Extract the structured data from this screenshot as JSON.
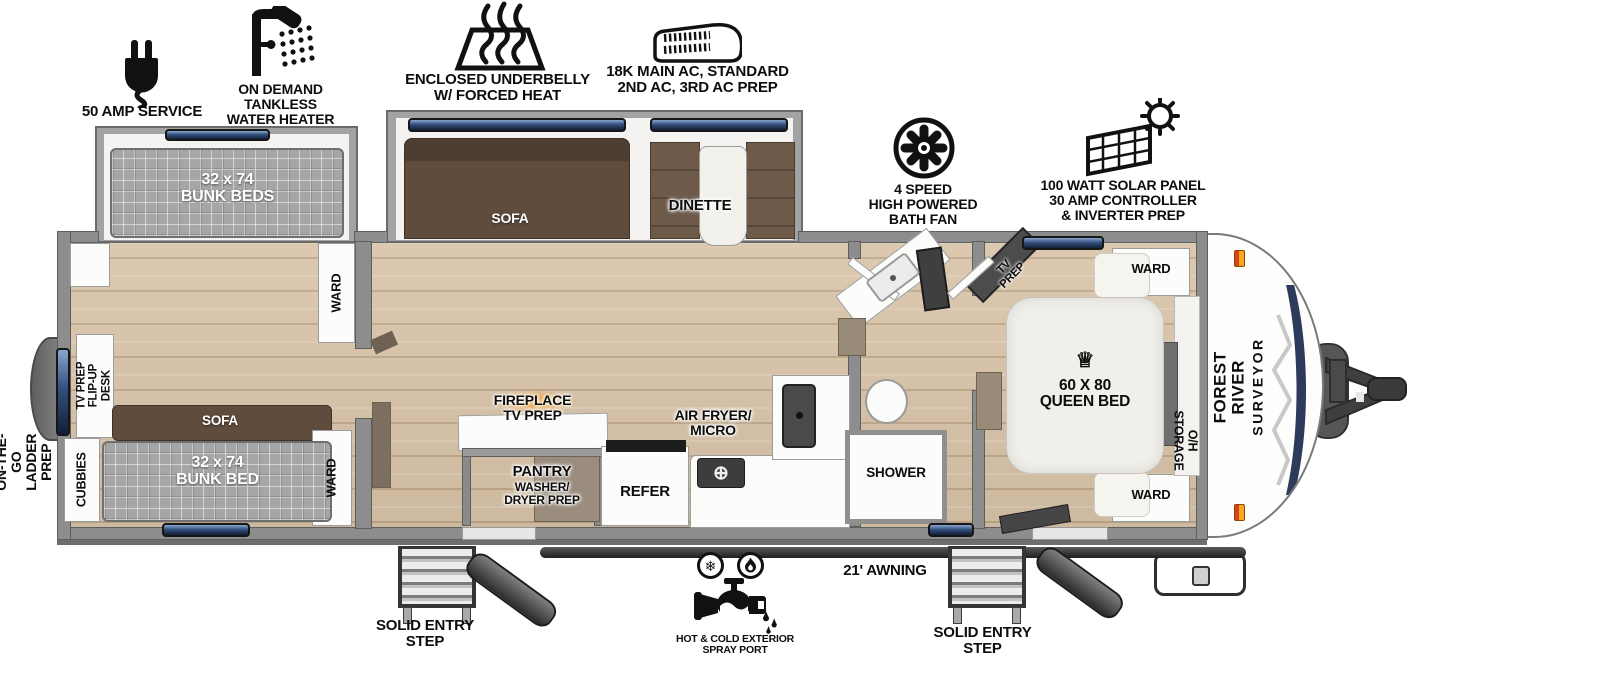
{
  "features": {
    "amp_service": "50 AMP SERVICE",
    "water_heater": "ON DEMAND\nTANKLESS\nWATER HEATER",
    "underbelly": "ENCLOSED UNDERBELLY\nW/ FORCED HEAT",
    "ac": "18K MAIN AC, STANDARD\n2ND AC, 3RD AC PREP",
    "bath_fan": "4 SPEED\nHIGH POWERED\nBATH FAN",
    "solar": "100 WATT SOLAR PANEL\n30 AMP CONTROLLER\n& INVERTER PREP"
  },
  "exterior": {
    "ladder_prep": "ON-THE-GO\nLADDER PREP",
    "awning": "21' AWNING",
    "spray_port": "HOT & COLD EXTERIOR\nSPRAY PORT",
    "entry_step_left": "SOLID ENTRY\nSTEP",
    "entry_step_right": "SOLID ENTRY\nSTEP",
    "brand_name": "FOREST RIVER",
    "brand_model": "SURVEYOR"
  },
  "bunk_room": {
    "bunk_beds_slide": "32 x 74\nBUNK BEDS",
    "ward_top": "WARD",
    "tv_prep_desk": "TV PREP\nFLIP-UP DESK",
    "sofa": "SOFA",
    "bunk_bed": "32 x 74\nBUNK BED",
    "cubbies": "CUBBIES",
    "ward_bottom": "WARD"
  },
  "living_area": {
    "sofa": "SOFA",
    "dinette": "DINETTE",
    "fireplace": "FIREPLACE\nTV PREP",
    "pantry_title": "PANTRY",
    "pantry_sub": "WASHER/\nDRYER PREP",
    "refer": "REFER",
    "air_fryer": "AIR FRYER/\nMICRO"
  },
  "bathroom": {
    "shower": "SHOWER"
  },
  "bedroom": {
    "tv_prep": "TV\nPREP",
    "crown": "♕",
    "queen_bed": "60 X 80\nQUEEN BED",
    "oh_storage": "O/H STORAGE",
    "ward_top": "WARD",
    "ward_bottom": "WARD"
  },
  "icons": {
    "snowflake": "❄",
    "burner": "⊕"
  },
  "colors": {
    "floor": "#d8c3a7",
    "wall": "#8d8d8d",
    "window_blue": "#33507e",
    "flame_orange": "#f59b23",
    "brand_navy": "#2e3a5c"
  }
}
